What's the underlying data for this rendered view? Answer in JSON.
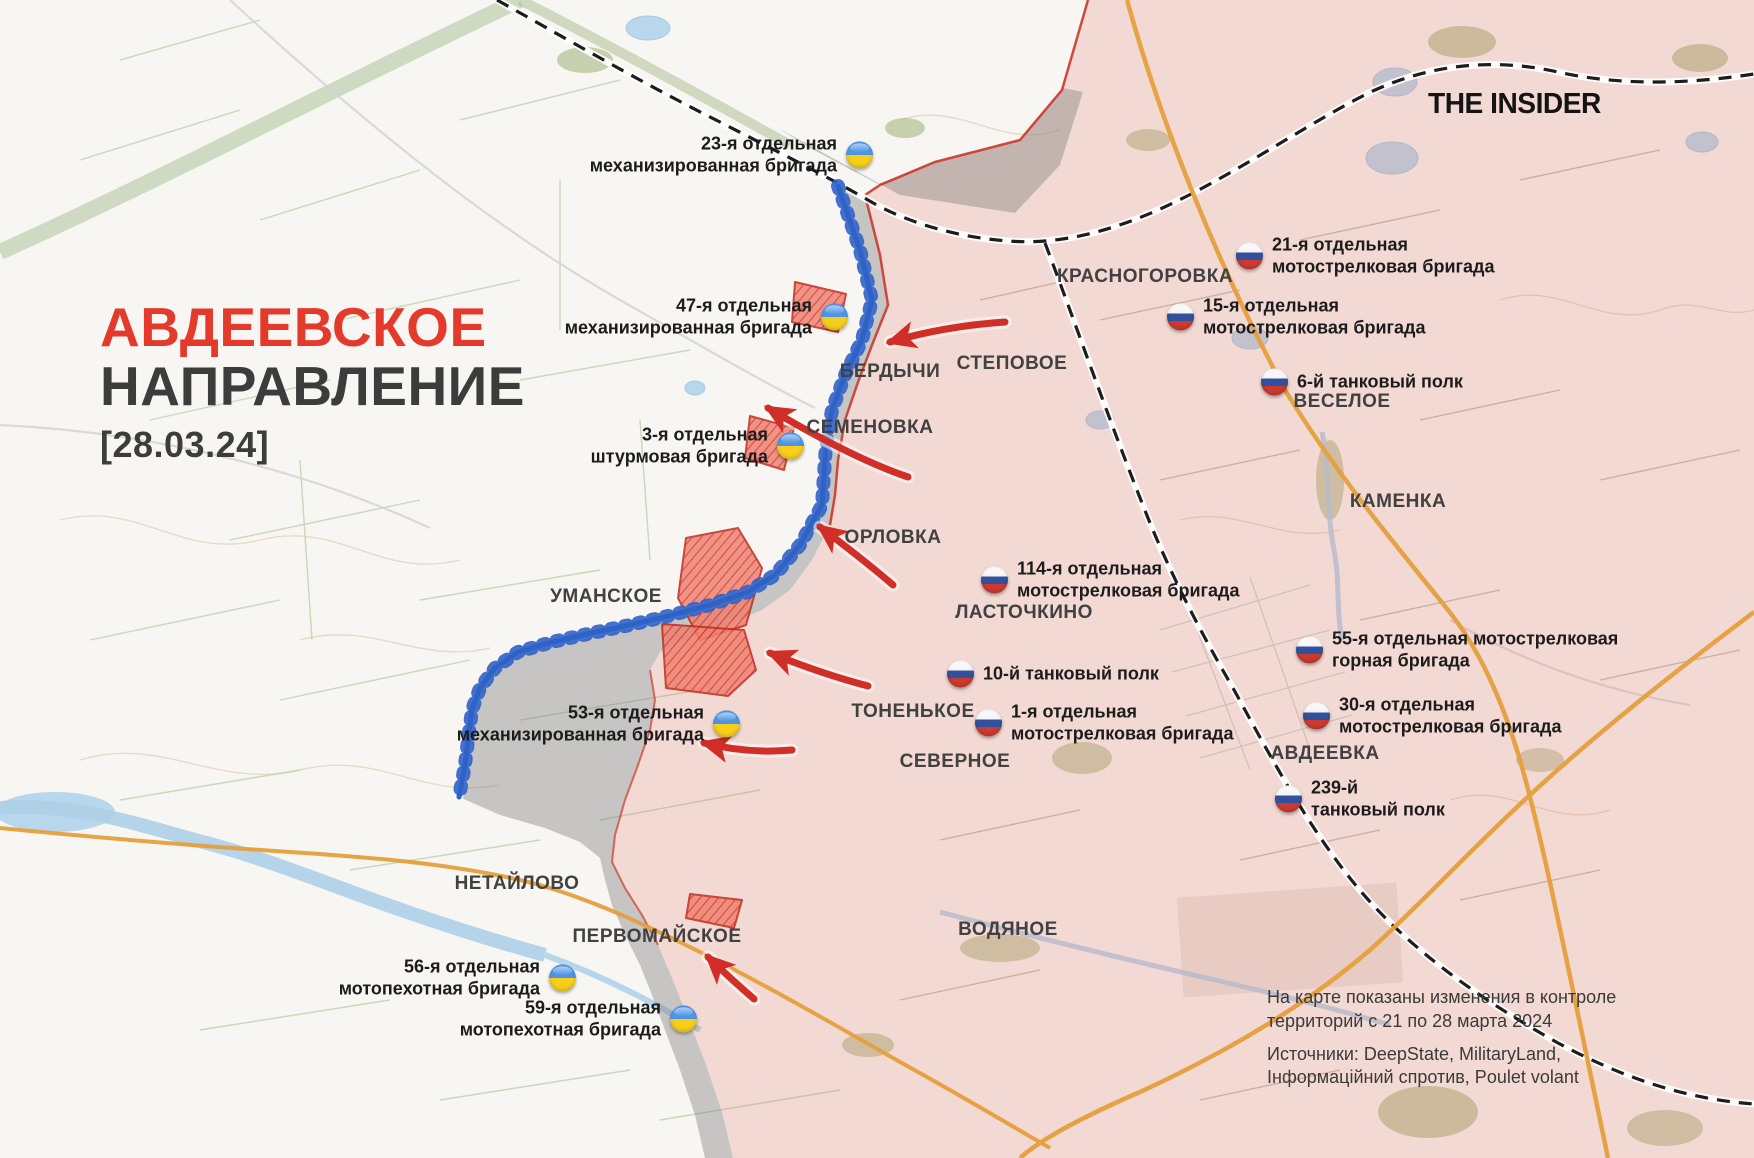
{
  "brand": "THE INSIDER",
  "title": {
    "line1": "АВДЕЕВСКОЕ",
    "line2": "НАПРАВЛЕНИЕ",
    "date": "[28.03.24]"
  },
  "note": {
    "line1": "На карте показаны изменения в контроле",
    "line2": "территорий с 21 по 28 марта 2024",
    "line3": "Источники: DeepState, MilitaryLand,",
    "line4": "Інформаційний спротив, Poulet volant"
  },
  "places": {
    "krasnohorivka": "КРАСНОГОРОВКА",
    "stepove": "СТЕПОВОЕ",
    "berdychi": "БЕРДЫЧИ",
    "semenivka": "СЕМЕНОВКА",
    "orlivka": "ОРЛОВКА",
    "umanske": "УМАНСКОЕ",
    "lastochkyne": "ЛАСТОЧКИНО",
    "vesele": "ВЕСЕЛОЕ",
    "kamianka": "КАМЕНКА",
    "tonenke": "ТОНЕНЬКОЕ",
    "severne": "СЕВЕРНОЕ",
    "avdiivka": "АВДЕЕВКА",
    "netailove": "НЕТАЙЛОВО",
    "pervomaiske": "ПЕРВОМАЙСКОЕ",
    "vodiane": "ВОДЯНОЕ"
  },
  "units_ua": {
    "u23": {
      "l1": "23-я отдельная",
      "l2": "механизированная бригада"
    },
    "u47": {
      "l1": "47-я отдельная",
      "l2": "механизированная бригада"
    },
    "u3": {
      "l1": "3-я отдельная",
      "l2": "штурмовая бригада"
    },
    "u53": {
      "l1": "53-я отдельная",
      "l2": "механизированная бригада"
    },
    "u56": {
      "l1": "56-я отдельная",
      "l2": "мотопехотная бригада"
    },
    "u59": {
      "l1": "59-я отдельная",
      "l2": "мотопехотная бригада"
    }
  },
  "units_ru": {
    "u21": {
      "l1": "21-я отдельная",
      "l2": "мотострелковая бригада"
    },
    "u15": {
      "l1": "15-я отдельная",
      "l2": "мотострелковая бригада"
    },
    "u6": {
      "l1": "6-й танковый полк"
    },
    "u114": {
      "l1": "114-я отдельная",
      "l2": "мотострелковая бригада"
    },
    "u10": {
      "l1": "10-й танковый полк"
    },
    "u1": {
      "l1": "1-я отдельная",
      "l2": "мотострелковая бригада"
    },
    "u55": {
      "l1": "55-я отдельная мотострелковая",
      "l2": "горная бригада"
    },
    "u30": {
      "l1": "30-я отдельная",
      "l2": "мотострелковая бригада"
    },
    "u239": {
      "l1": "239-й",
      "l2": "танковый полк"
    }
  },
  "colors": {
    "accent_red": "#e43a2c",
    "controlled_pink": "#f3d9d4",
    "contested_gray": "#d9d9d9",
    "advance_fill": "#ef8271",
    "advance_line": "#cd3327",
    "frontline_blue": "#2f62c6",
    "ukraine_blue": "#4e94e4",
    "ukraine_yellow": "#f6cf1b",
    "russia_blue": "#32519c",
    "russia_red": "#cc3a31",
    "road_orange": "#e59f3c"
  }
}
